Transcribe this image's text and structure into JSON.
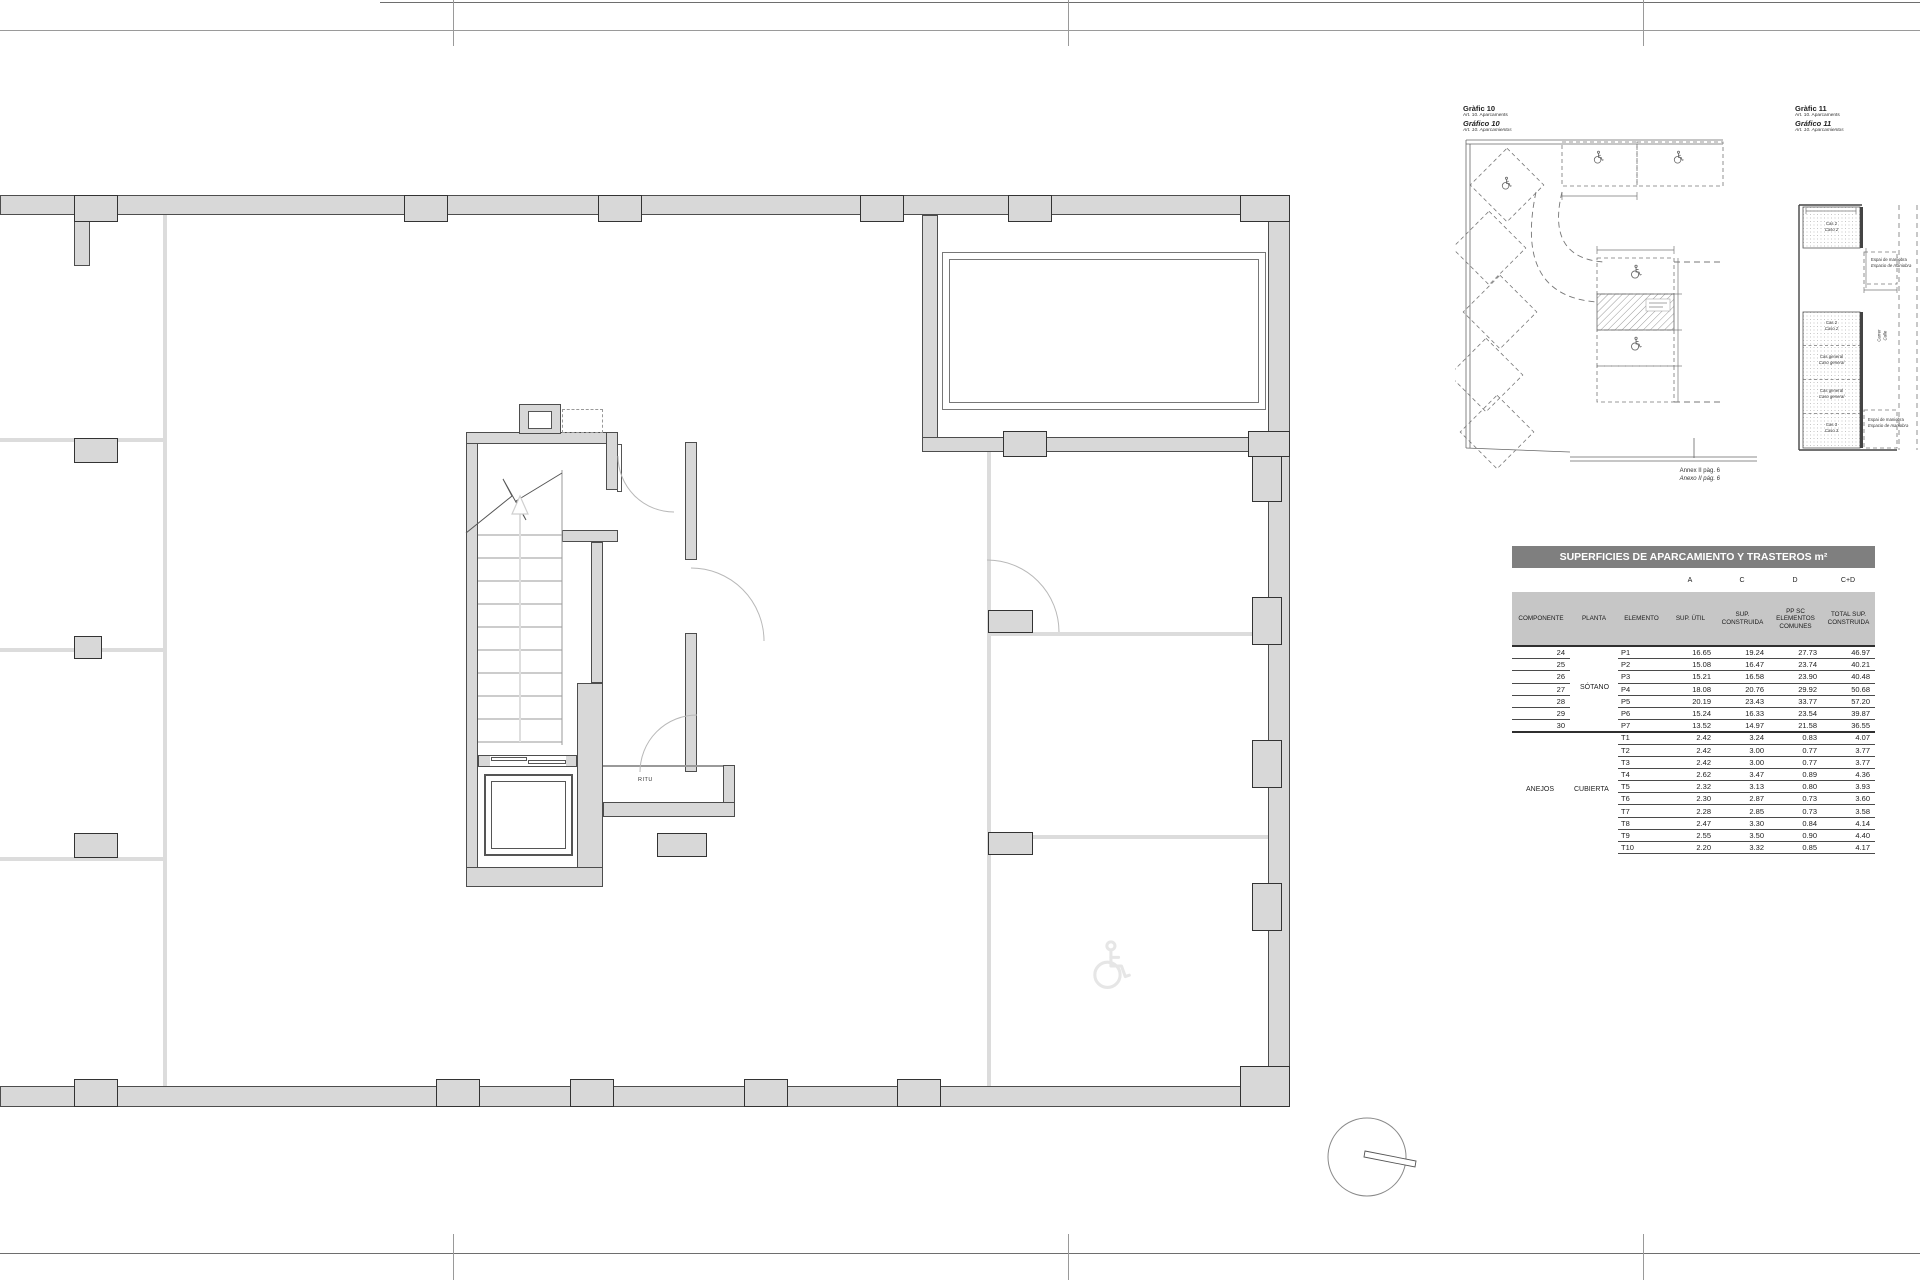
{
  "plan": {
    "ritu_label": "RITU"
  },
  "grafico10": {
    "title1": "Gràfic 10",
    "title2": "Art. 10. Aparcaments",
    "title3": "Gráfico 10",
    "title4": "Art. 10. Aparcamientos",
    "caption1": "Annex II pàg. 6",
    "caption2": "Anexo II pág. 6"
  },
  "grafico11": {
    "title1": "Gràfic 11",
    "title2": "Art. 10. Aparcaments",
    "title3": "Gráfico 11",
    "title4": "Art. 10. Aparcamientos",
    "top_bay": {
      "l1": "Cas 2",
      "l2": "Caso 2"
    },
    "maneuver_top": {
      "l1": "Espai de maniobra",
      "l2": "Espacio de maniobra"
    },
    "bays": [
      {
        "l1": "Cas 2",
        "l2": "Caso 2"
      },
      {
        "l1": "Cas general",
        "l2": "Caso general"
      },
      {
        "l1": "Cas general",
        "l2": "Caso general"
      },
      {
        "l1": "Cas 3",
        "l2": "Caso 3"
      }
    ],
    "street": {
      "l1": "Carrer",
      "l2": "Calle"
    },
    "maneuver_bottom": {
      "l1": "Espai de maniobra",
      "l2": "Espacio de maniobra"
    }
  },
  "table": {
    "title": "SUPERFICIES DE APARCAMIENTO Y TRASTEROS m²",
    "letters": [
      "A",
      "C",
      "D",
      "C+D"
    ],
    "columns": [
      "COMPONENTE",
      "PLANTA",
      "ELEMENTO",
      "SUP. ÚTIL",
      "SUP. CONSTRUIDA",
      "PP SC ELEMENTOS COMUNES",
      "TOTAL SUP. CONSTRUIDA"
    ],
    "group_p": {
      "componente_label": "",
      "planta": "SÓTANO",
      "rows": [
        [
          "24",
          "P1",
          "16.65",
          "19.24",
          "27.73",
          "46.97"
        ],
        [
          "25",
          "P2",
          "15.08",
          "16.47",
          "23.74",
          "40.21"
        ],
        [
          "26",
          "P3",
          "15.21",
          "16.58",
          "23.90",
          "40.48"
        ],
        [
          "27",
          "P4",
          "18.08",
          "20.76",
          "29.92",
          "50.68"
        ],
        [
          "28",
          "P5",
          "20.19",
          "23.43",
          "33.77",
          "57.20"
        ],
        [
          "29",
          "P6",
          "15.24",
          "16.33",
          "23.54",
          "39.87"
        ],
        [
          "30",
          "P7",
          "13.52",
          "14.97",
          "21.58",
          "36.55"
        ]
      ]
    },
    "group_t": {
      "componente_label": "ANEJOS",
      "planta": "CUBIERTA",
      "rows": [
        [
          "",
          "T1",
          "2.42",
          "3.24",
          "0.83",
          "4.07"
        ],
        [
          "",
          "T2",
          "2.42",
          "3.00",
          "0.77",
          "3.77"
        ],
        [
          "",
          "T3",
          "2.42",
          "3.00",
          "0.77",
          "3.77"
        ],
        [
          "",
          "T4",
          "2.62",
          "3.47",
          "0.89",
          "4.36"
        ],
        [
          "",
          "T5",
          "2.32",
          "3.13",
          "0.80",
          "3.93"
        ],
        [
          "",
          "T6",
          "2.30",
          "2.87",
          "0.73",
          "3.60"
        ],
        [
          "",
          "T7",
          "2.28",
          "2.85",
          "0.73",
          "3.58"
        ],
        [
          "",
          "T8",
          "2.47",
          "3.30",
          "0.84",
          "4.14"
        ],
        [
          "",
          "T9",
          "2.55",
          "3.50",
          "0.90",
          "4.40"
        ],
        [
          "",
          "T10",
          "2.20",
          "3.32",
          "0.85",
          "4.17"
        ]
      ]
    }
  }
}
